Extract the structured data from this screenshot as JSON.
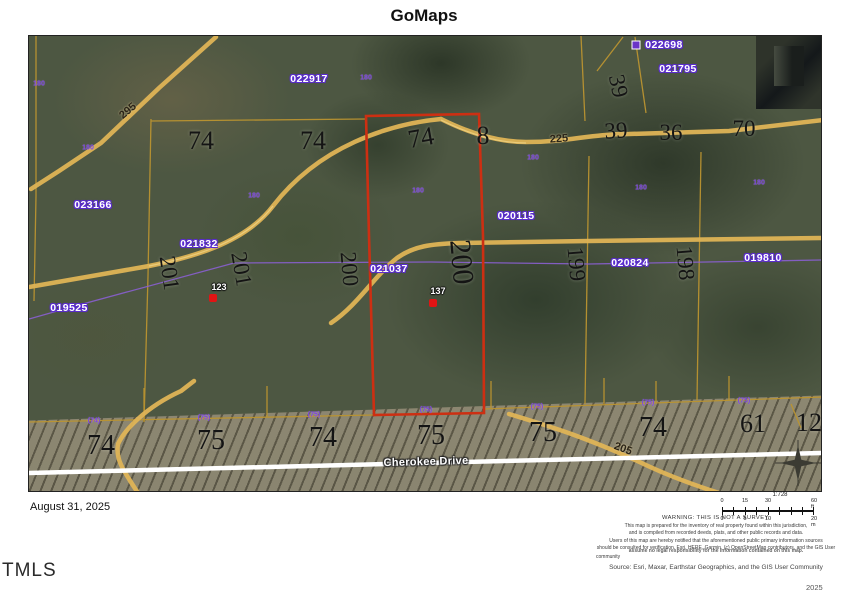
{
  "title": "GoMaps",
  "date_label": "August 31, 2025",
  "watermark": "TMLS",
  "year_label": "2025",
  "colors": {
    "highlight_parcel": "#cd2f12",
    "road": "#dfb456",
    "lot_line": "#bb9430",
    "parcel_id_halo": "#5a2bd0",
    "easement_line": "#8a5fd0",
    "marker_dot": "#e11414",
    "street_road": "#ffffff"
  },
  "map": {
    "street_name": "Cherokee Drive",
    "parcel_ids": [
      {
        "text": "022698",
        "x": 635,
        "y": 9
      },
      {
        "text": "021795",
        "x": 649,
        "y": 33
      },
      {
        "text": "022917",
        "x": 280,
        "y": 43
      },
      {
        "text": "023166",
        "x": 64,
        "y": 169
      },
      {
        "text": "021832",
        "x": 170,
        "y": 208
      },
      {
        "text": "019525",
        "x": 40,
        "y": 272
      },
      {
        "text": "021037",
        "x": 360,
        "y": 233
      },
      {
        "text": "020115",
        "x": 487,
        "y": 180
      },
      {
        "text": "020824",
        "x": 601,
        "y": 227
      },
      {
        "text": "019810",
        "x": 734,
        "y": 222
      }
    ],
    "lot_numbers": [
      {
        "text": "74",
        "x": 172,
        "y": 105,
        "rot": 0,
        "size": 26
      },
      {
        "text": "74",
        "x": 284,
        "y": 105,
        "rot": 0,
        "size": 26
      },
      {
        "text": "74",
        "x": 392,
        "y": 102,
        "rot": -10,
        "size": 26
      },
      {
        "text": "8",
        "x": 454,
        "y": 100,
        "rot": 0,
        "size": 26
      },
      {
        "text": "39",
        "x": 589,
        "y": 50,
        "rot": 78,
        "size": 23
      },
      {
        "text": "39",
        "x": 587,
        "y": 95,
        "rot": -4,
        "size": 23
      },
      {
        "text": "36",
        "x": 642,
        "y": 97,
        "rot": 0,
        "size": 23
      },
      {
        "text": "70",
        "x": 715,
        "y": 93,
        "rot": 0,
        "size": 23
      },
      {
        "text": "201",
        "x": 140,
        "y": 237,
        "rot": 82,
        "size": 23
      },
      {
        "text": "201",
        "x": 212,
        "y": 233,
        "rot": 80,
        "size": 23
      },
      {
        "text": "200",
        "x": 320,
        "y": 233,
        "rot": 85,
        "size": 23
      },
      {
        "text": "200",
        "x": 432,
        "y": 226,
        "rot": 85,
        "size": 30
      },
      {
        "text": "199",
        "x": 547,
        "y": 228,
        "rot": 85,
        "size": 23
      },
      {
        "text": "198",
        "x": 656,
        "y": 227,
        "rot": 85,
        "size": 23
      },
      {
        "text": "74",
        "x": 72,
        "y": 410,
        "rot": 0,
        "size": 28
      },
      {
        "text": "75",
        "x": 182,
        "y": 405,
        "rot": 0,
        "size": 28
      },
      {
        "text": "74",
        "x": 294,
        "y": 402,
        "rot": 0,
        "size": 28
      },
      {
        "text": "75",
        "x": 402,
        "y": 400,
        "rot": 0,
        "size": 28
      },
      {
        "text": "75",
        "x": 514,
        "y": 397,
        "rot": 0,
        "size": 28
      },
      {
        "text": "74",
        "x": 624,
        "y": 392,
        "rot": 0,
        "size": 28
      },
      {
        "text": "61",
        "x": 724,
        "y": 388,
        "rot": 0,
        "size": 26
      },
      {
        "text": "12",
        "x": 780,
        "y": 387,
        "rot": 0,
        "size": 26
      }
    ],
    "road_labels": [
      {
        "text": "295",
        "x": 99,
        "y": 75,
        "rot": -40,
        "variant": "black"
      },
      {
        "text": "225",
        "x": 530,
        "y": 103,
        "rot": -4,
        "variant": "black"
      },
      {
        "text": "205",
        "x": 594,
        "y": 413,
        "rot": 20,
        "variant": "black"
      },
      {
        "text": "Cherokee Drive",
        "x": 397,
        "y": 426,
        "rot": -1.5,
        "variant": "white"
      }
    ],
    "small_labels": [
      {
        "text": "(74)",
        "x": 65,
        "y": 385
      },
      {
        "text": "(75)",
        "x": 175,
        "y": 382
      },
      {
        "text": "(75)",
        "x": 285,
        "y": 379
      },
      {
        "text": "(75)",
        "x": 397,
        "y": 374
      },
      {
        "text": "(75)",
        "x": 508,
        "y": 371
      },
      {
        "text": "(75)",
        "x": 619,
        "y": 367
      },
      {
        "text": "(75)",
        "x": 715,
        "y": 365
      },
      {
        "text": "180",
        "x": 10,
        "y": 48
      },
      {
        "text": "180",
        "x": 337,
        "y": 42
      },
      {
        "text": "180",
        "x": 504,
        "y": 122
      },
      {
        "text": "180",
        "x": 225,
        "y": 160
      },
      {
        "text": "180",
        "x": 612,
        "y": 152
      },
      {
        "text": "180",
        "x": 59,
        "y": 112
      },
      {
        "text": "180",
        "x": 730,
        "y": 147
      },
      {
        "text": "180",
        "x": 389,
        "y": 155
      }
    ],
    "markers": [
      {
        "text": "123",
        "x": 184,
        "y": 262,
        "lx": 190,
        "ly": 251
      },
      {
        "text": "137",
        "x": 404,
        "y": 267,
        "lx": 409,
        "ly": 255
      }
    ]
  },
  "scale": {
    "ratio": "1:728",
    "ft_ticks": [
      "0",
      "15",
      "30",
      "60 ft"
    ],
    "m_ticks": [
      "0",
      "5",
      "10",
      "20 m"
    ]
  },
  "disclaimer": {
    "warning": "WARNING: THIS IS NOT A SURVEY.",
    "line1": "This map is prepared for the inventory of real property found within this jurisdiction,",
    "line2": "and is compiled from recorded deeds, plats, and other public records and data.",
    "line3": "Users of this map are hereby notified that the aforementioned public primary information sources",
    "garble1": "should be consulted for verification. Esri, HERE, Garmin, (c) OpenStreetMap contributors, and the GIS User",
    "garble2": "assume no legal responsibility for the information contained on this map.",
    "community": "community",
    "source": "Source: Esri, Maxar, Earthstar Geographics, and the GIS User Community"
  }
}
